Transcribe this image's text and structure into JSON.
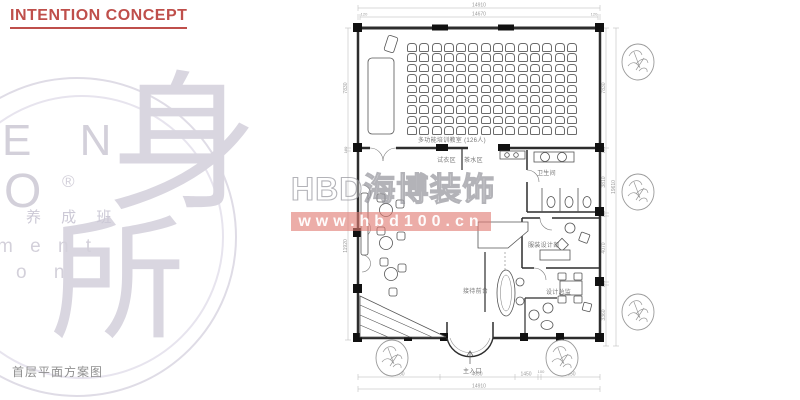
{
  "page": {
    "title": "INTENTION CONCEPT",
    "caption": "首层平面方案图"
  },
  "logo": {
    "fragments": [
      "E N",
      "O",
      "®",
      "养 成 班",
      "m e n t",
      "o n"
    ],
    "glyph_top": "身",
    "glyph_bottom": "所"
  },
  "watermark": {
    "text": "HBD海博装饰",
    "url": "www.hbd100.cn",
    "band_color": "#e07a73"
  },
  "plan": {
    "classroom": {
      "rows": 9,
      "cols": 14,
      "label": "多功能培训教室 (126人)"
    },
    "rooms": {
      "fitting": "试衣区",
      "tea": "茶水区",
      "toilet": "卫生间",
      "design_dept": "服装设计部",
      "design_director": "设计总监",
      "reception": "接待前台",
      "entrance": "主入口"
    },
    "dims": {
      "top_total": "14910",
      "top_inner": "14670",
      "top_end_left": "120",
      "top_end_right": "120",
      "bottom": [
        "5060",
        "4650",
        "1450",
        "100",
        "3650"
      ],
      "bottom_total": "14910",
      "left": [
        "7830",
        "180",
        "11920"
      ],
      "right": [
        "7830",
        "180",
        "3810",
        "180",
        "4070",
        "180",
        "3360"
      ],
      "right_total": "19610"
    },
    "colors": {
      "line": "#3a3a3a",
      "dim_line": "#b5b5b5",
      "accent_title": "#bf4f4b"
    }
  }
}
